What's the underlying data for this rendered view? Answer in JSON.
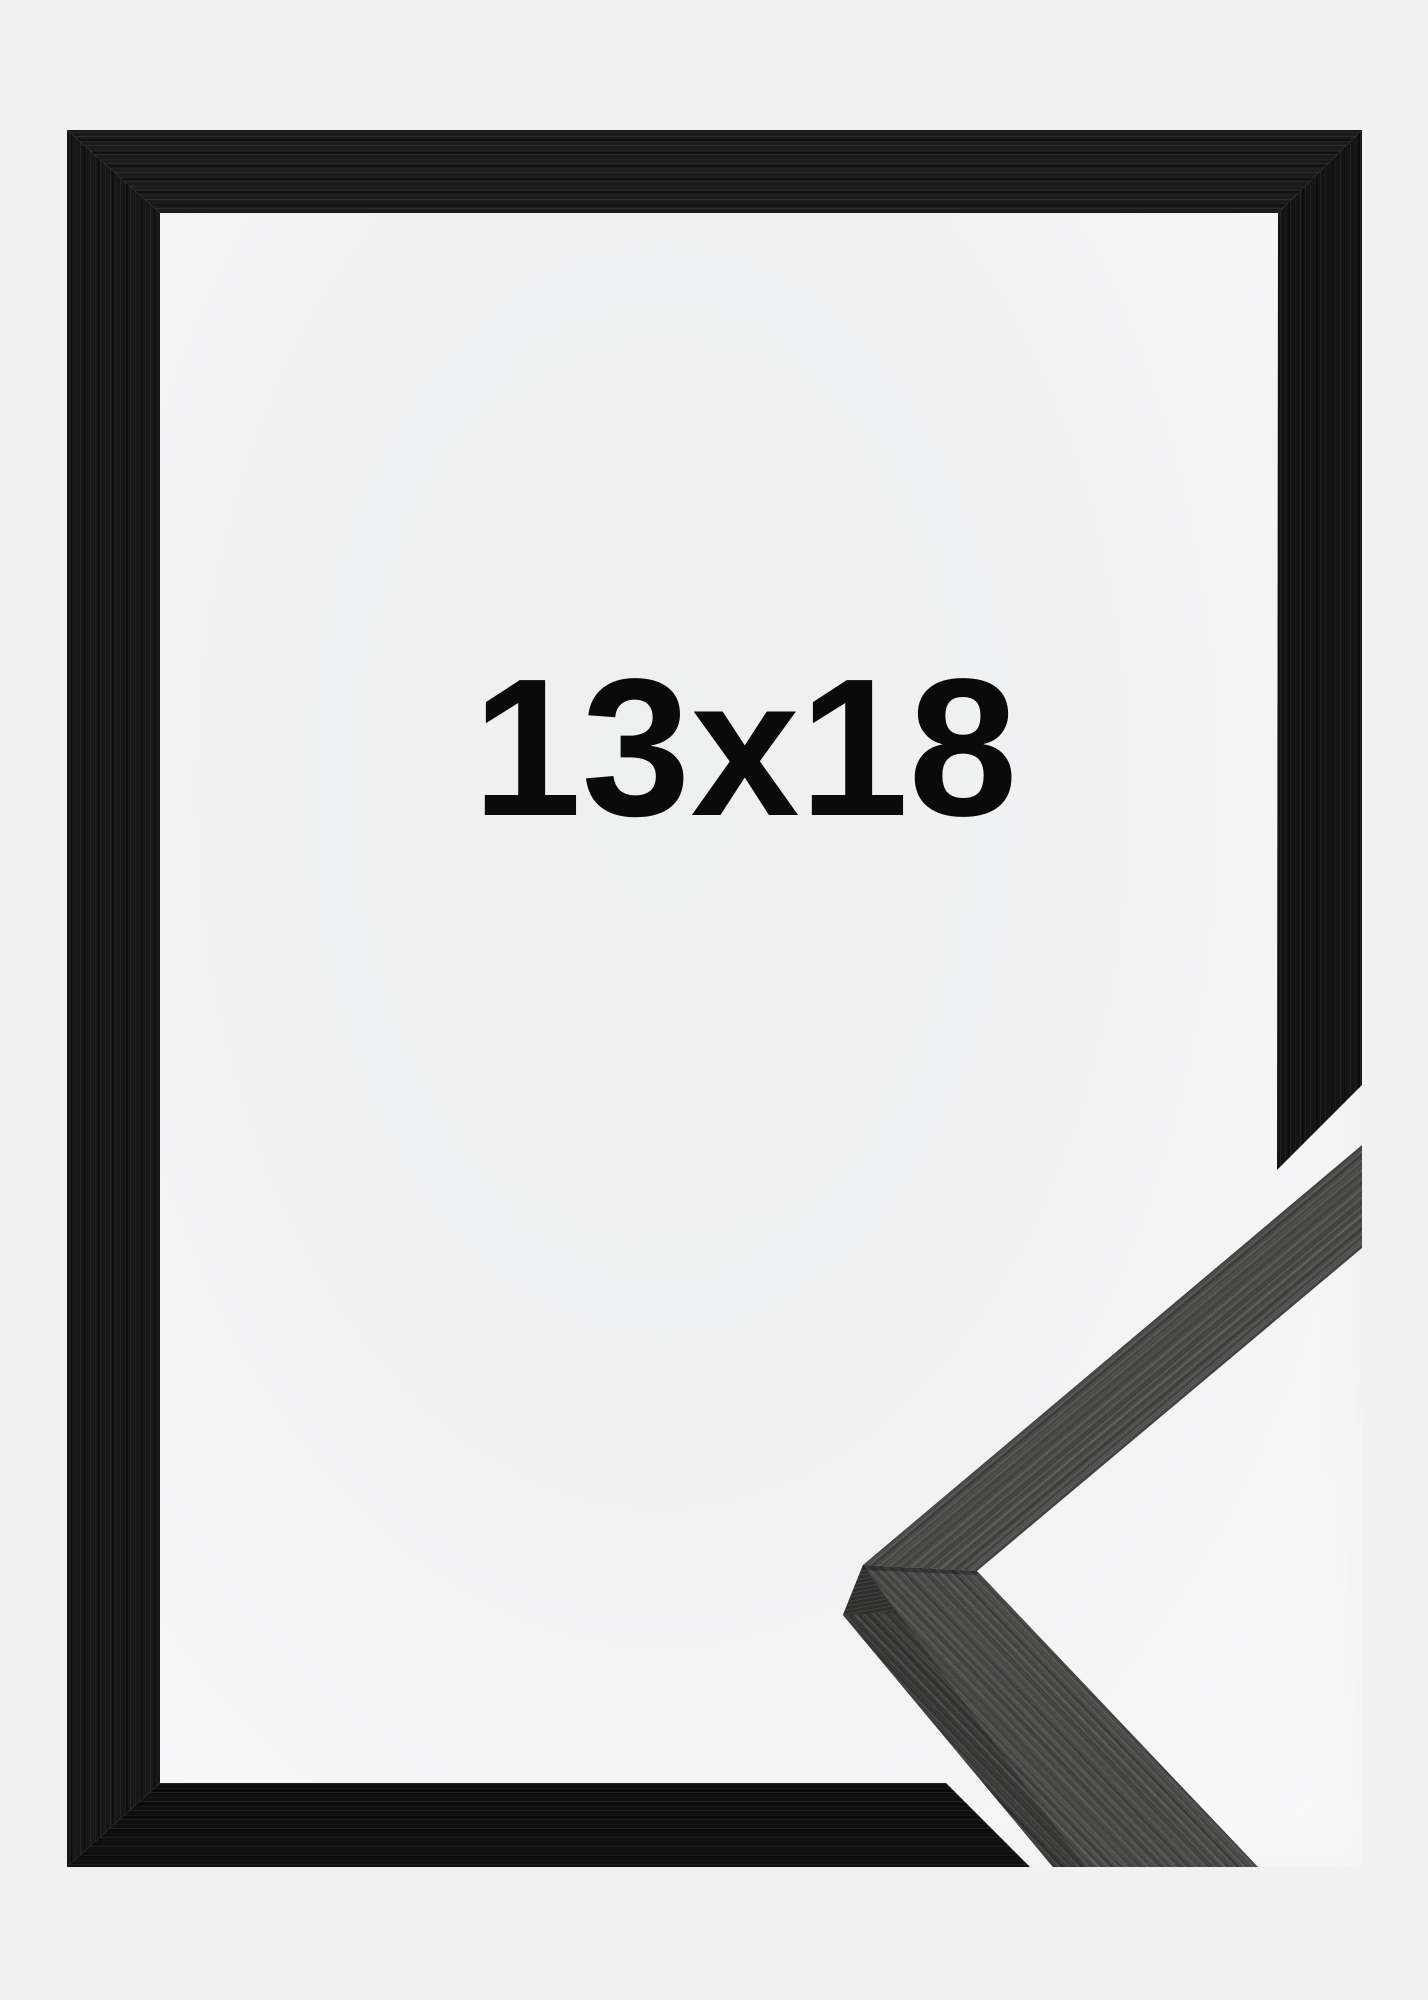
{
  "image": {
    "type": "product-photo",
    "subject": "black wooden picture frame with mitered corner profile sample",
    "size_label": "13x18"
  },
  "colors": {
    "page_background": "#f1f1f2",
    "paper_white": "#f7f7f8",
    "frame_black": "#161616",
    "sample_grey": "#4a4a49",
    "label_text": "#0a0a0a"
  }
}
